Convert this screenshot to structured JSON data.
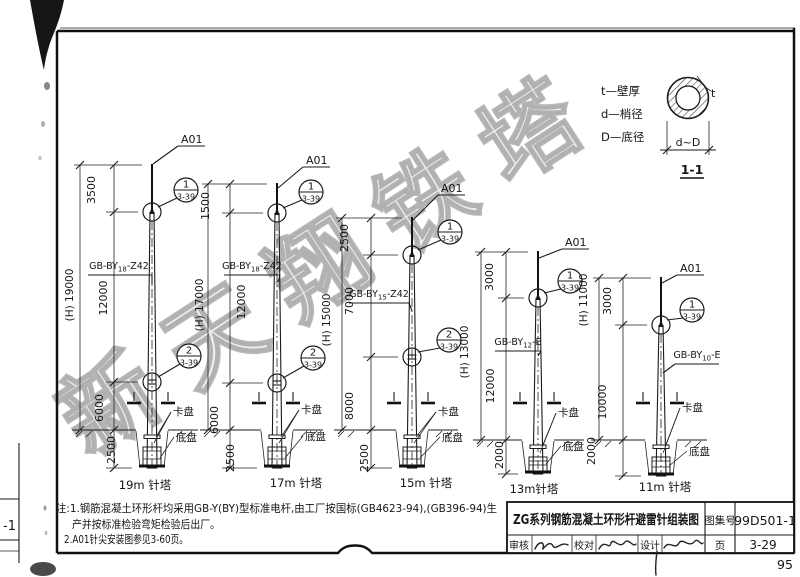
{
  "watermark": "新天翔铁塔",
  "page": {
    "number": "95",
    "adjacent_fragment": "-1"
  },
  "legend": {
    "lines": [
      "t—壁厚",
      "d—梢径",
      "D—底径"
    ],
    "thickness_label": "t",
    "section_dim": "d~D",
    "section_label": "1-1"
  },
  "notes": {
    "line1": "注:1.钢筋混凝土环形杆均采用GB-Y(BY)型标准电杆,由工厂按国标(GB4623-94),(GB396-94)生",
    "line2": "产并按标准检验弯矩检验后出厂。",
    "line3": "2.A01针尖安装图参见3-60页。"
  },
  "title_block": {
    "title": "ZG系列钢筋混凝土环形杆避雷针组装图",
    "atlas_label": "图集号",
    "atlas_no": "99D501-1",
    "page_label": "页",
    "page_no": "3-29",
    "reviewer_label": "审核",
    "checker_label": "校对",
    "designer_label": "设计"
  },
  "poles": [
    {
      "name": "19m 针塔",
      "apex": "A01",
      "spec": {
        "prefix": "GB-BY",
        "sub": "18",
        "suffix": "-Z42"
      },
      "callouts": [
        {
          "num": "1",
          "ref": "3-39"
        },
        {
          "num": "2",
          "ref": "3-39"
        }
      ],
      "segments": [
        "3500",
        "12000",
        "6000"
      ],
      "buried": "2500",
      "overall": "(H) 19000",
      "clamp_label": "卡盘",
      "base_label": "底盘"
    },
    {
      "name": "17m 针塔",
      "apex": "A01",
      "spec": {
        "prefix": "GB-BY",
        "sub": "18",
        "suffix": "-Z42"
      },
      "callouts": [
        {
          "num": "1",
          "ref": "3-39"
        },
        {
          "num": "2",
          "ref": "3-39"
        }
      ],
      "segments": [
        "1500",
        "12000",
        "6000"
      ],
      "buried": "2500",
      "overall": "(H) 17000",
      "clamp_label": "卡盘",
      "base_label": "底盘"
    },
    {
      "name": "15m 针塔",
      "apex": "A01",
      "spec": {
        "prefix": "GB-BY",
        "sub": "15",
        "suffix": "-Z42"
      },
      "callouts": [
        {
          "num": "1",
          "ref": "3-39"
        },
        {
          "num": "2",
          "ref": "3-39"
        }
      ],
      "segments": [
        "2500",
        "7000",
        "8000"
      ],
      "buried": "2500",
      "overall": "(H) 15000",
      "clamp_label": "卡盘",
      "base_label": "底盘"
    },
    {
      "name": "13m针塔",
      "apex": "A01",
      "spec": {
        "prefix": "GB-BY",
        "sub": "12",
        "suffix": "-E"
      },
      "callouts": [
        {
          "num": "1",
          "ref": "3-39"
        }
      ],
      "segments": [
        "3000",
        "12000"
      ],
      "buried": "2000",
      "overall": "(H) 13000",
      "clamp_label": "卡盘",
      "base_label": "底盘"
    },
    {
      "name": "11m 针塔",
      "apex": "A01",
      "spec": {
        "prefix": "GB-BY",
        "sub": "10",
        "suffix": "-E"
      },
      "callouts": [
        {
          "num": "1",
          "ref": "3-39"
        }
      ],
      "segments": [
        "3000",
        "10000"
      ],
      "buried": "2000",
      "overall": "(H) 11000",
      "clamp_label": "卡盘",
      "base_label": "底盘"
    }
  ]
}
